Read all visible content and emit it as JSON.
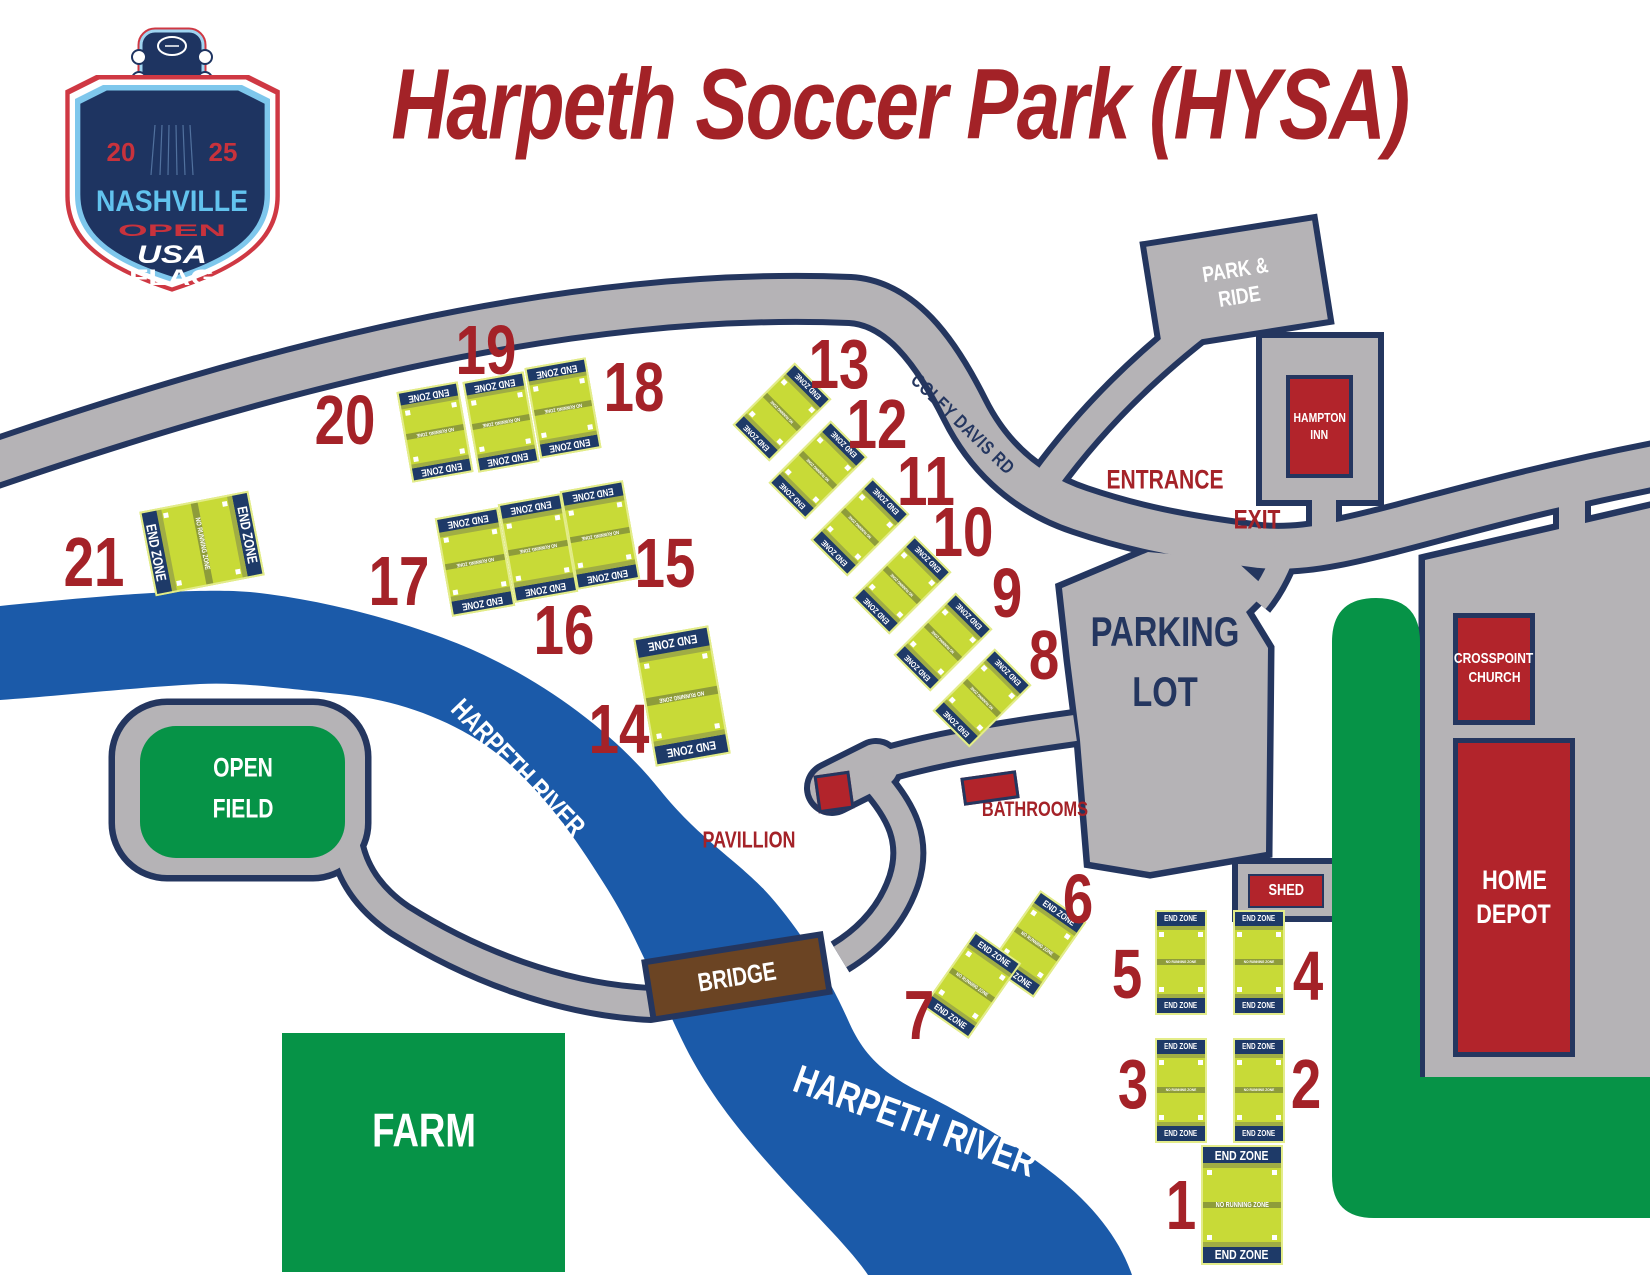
{
  "title": "Harpeth Soccer Park (HYSA)",
  "logo": {
    "year_left": "20",
    "year_right": "25",
    "city": "NASHVILLE",
    "event": "OPEN",
    "org_top": "USA",
    "org_bottom": "FLAG"
  },
  "strings": {
    "end_zone": "END ZONE",
    "no_running_zone": "NO RUNNING ZONE"
  },
  "labels": {
    "coley_davis_rd": "COLEY DAVIS RD",
    "entrance": "ENTRANCE",
    "exit": "EXIT",
    "parking_line1": "PARKING",
    "parking_line2": "LOT",
    "park_ride_line1": "PARK &",
    "park_ride_line2": "RIDE",
    "hampton_line1": "HAMPTON",
    "hampton_line2": "INN",
    "crosspoint_line1": "CROSSPOINT",
    "crosspoint_line2": "CHURCH",
    "home_depot_line1": "HOME",
    "home_depot_line2": "DEPOT",
    "shed": "SHED",
    "bathrooms": "BATHROOMS",
    "pavillion": "PAVILLION",
    "bridge": "BRIDGE",
    "open_field_line1": "OPEN",
    "open_field_line2": "FIELD",
    "farm": "FARM",
    "river": "HARPETH RIVER"
  },
  "colors": {
    "red_text": "#a42228",
    "navy": "#24365f",
    "road_gray": "#b5b3b6",
    "river_blue": "#1b5aa9",
    "green": "#069347",
    "field_green": "#c8da37",
    "band_olive": "#8e9c3a",
    "building_red": "#b2242b",
    "bridge_brown": "#6b4423"
  },
  "fields": [
    {
      "number": 1,
      "x": 1242,
      "y": 1205,
      "w": 82,
      "h": 120,
      "rot": 0,
      "nx": 1181,
      "ny": 1205
    },
    {
      "number": 2,
      "x": 1259,
      "y": 1090,
      "w": 52,
      "h": 105,
      "rot": 0,
      "nx": 1306,
      "ny": 1084
    },
    {
      "number": 3,
      "x": 1181,
      "y": 1090,
      "w": 52,
      "h": 105,
      "rot": 0,
      "nx": 1133,
      "ny": 1084
    },
    {
      "number": 4,
      "x": 1259,
      "y": 962,
      "w": 52,
      "h": 105,
      "rot": 0,
      "nx": 1308,
      "ny": 976
    },
    {
      "number": 5,
      "x": 1181,
      "y": 962,
      "w": 52,
      "h": 105,
      "rot": 0,
      "nx": 1127,
      "ny": 974
    },
    {
      "number": 6,
      "x": 1037,
      "y": 944,
      "w": 56,
      "h": 92,
      "rot": 35,
      "nx": 1078,
      "ny": 899
    },
    {
      "number": 7,
      "x": 972,
      "y": 985,
      "w": 56,
      "h": 92,
      "rot": 35,
      "nx": 919,
      "ny": 1015
    },
    {
      "number": 8,
      "x": 982,
      "y": 698,
      "w": 52,
      "h": 88,
      "rot": 225,
      "nx": 1044,
      "ny": 655
    },
    {
      "number": 9,
      "x": 943,
      "y": 642,
      "w": 52,
      "h": 88,
      "rot": 225,
      "nx": 1007,
      "ny": 593
    },
    {
      "number": 10,
      "x": 902,
      "y": 585,
      "w": 52,
      "h": 88,
      "rot": 225,
      "nx": 963,
      "ny": 532
    },
    {
      "number": 11,
      "x": 860,
      "y": 527,
      "w": 52,
      "h": 88,
      "rot": 225,
      "nx": 926,
      "ny": 481
    },
    {
      "number": 12,
      "x": 818,
      "y": 470,
      "w": 52,
      "h": 88,
      "rot": 225,
      "nx": 877,
      "ny": 424
    },
    {
      "number": 13,
      "x": 782,
      "y": 412,
      "w": 52,
      "h": 88,
      "rot": 225,
      "nx": 839,
      "ny": 364
    },
    {
      "number": 14,
      "x": 682,
      "y": 696,
      "w": 76,
      "h": 130,
      "rot": 170,
      "nx": 619,
      "ny": 729
    },
    {
      "number": 15,
      "x": 600,
      "y": 535,
      "w": 64,
      "h": 100,
      "rot": 170,
      "nx": 665,
      "ny": 563
    },
    {
      "number": 16,
      "x": 538,
      "y": 548,
      "w": 64,
      "h": 100,
      "rot": 170,
      "nx": 564,
      "ny": 630
    },
    {
      "number": 17,
      "x": 475,
      "y": 562,
      "w": 64,
      "h": 100,
      "rot": 170,
      "nx": 399,
      "ny": 581
    },
    {
      "number": 18,
      "x": 563,
      "y": 408,
      "w": 62,
      "h": 92,
      "rot": 170,
      "nx": 634,
      "ny": 387
    },
    {
      "number": 19,
      "x": 501,
      "y": 422,
      "w": 62,
      "h": 92,
      "rot": 170,
      "nx": 486,
      "ny": 350
    },
    {
      "number": 20,
      "x": 435,
      "y": 432,
      "w": 62,
      "h": 92,
      "rot": 170,
      "nx": 345,
      "ny": 420
    },
    {
      "number": 21,
      "x": 202,
      "y": 543,
      "w": 86,
      "h": 111,
      "rot": 79,
      "nx": 94,
      "ny": 562
    }
  ]
}
